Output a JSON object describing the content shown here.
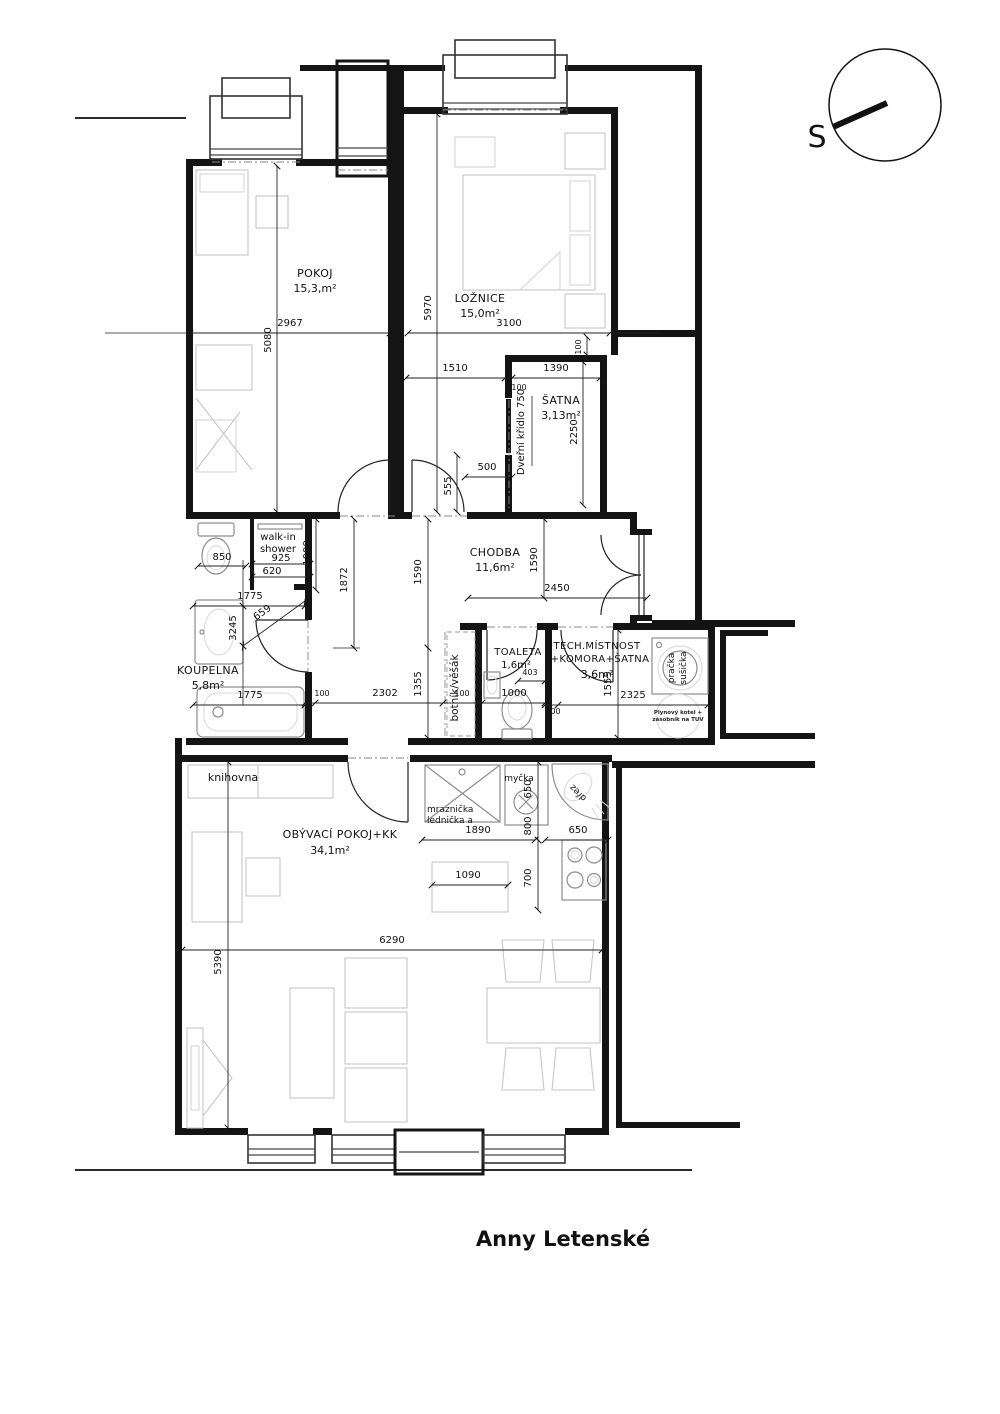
{
  "title": "Anny Letenské",
  "compass": {
    "label": "S"
  },
  "rooms": {
    "pokoj": {
      "name": "POKOJ",
      "area": "15,3,m²"
    },
    "loznice": {
      "name": "LOŽNICE",
      "area": "15,0m²"
    },
    "satna": {
      "name": "ŠATNA",
      "area": "3,13m²"
    },
    "chodba": {
      "name": "CHODBA",
      "area": "11,6m²"
    },
    "koupelna": {
      "name": "KOUPELNA",
      "area": "5,8m²"
    },
    "toaleta": {
      "name": "TOALETA",
      "area": "1,6m²"
    },
    "tech": {
      "name": "TECH.MÍSTNOST",
      "name2": "+KOMORA+ŠATNA",
      "area": "3,6m²"
    },
    "obyvaci": {
      "name": "OBÝVACÍ  POKOJ+KK",
      "area": "34,1m²"
    }
  },
  "labels": {
    "shower1": "walk-in",
    "shower2": "shower",
    "door_leaf": "Dveřní křídlo 750",
    "botnik": "botník/věšák",
    "pracka1": "pračka",
    "pracka2": "sušička",
    "kotel1": "Plynový kotel +",
    "kotel2": "zásobník na TUV",
    "knihovna": "knihovna",
    "mraz1": "mraznička",
    "mraz2": "lednička a",
    "mycka": "myčka",
    "drez": "dřez"
  },
  "dims": {
    "pokoj_w": "2967",
    "pokoj_h": "5080",
    "loz_h": "5970",
    "loz_w": "3100",
    "satna_off": "1510",
    "satna_w": "1390",
    "satna_h": "2250",
    "satna_gap_v": "100",
    "satna_gap_h": "100",
    "satna_door_w": "500",
    "satna_door_off": "555",
    "shower_w": "925",
    "shower_620": "620",
    "shower_1000": "1000",
    "koup_1775a": "1775",
    "koup_1775b": "1775",
    "koup_h": "3245",
    "koup_diag": "659",
    "wc_off": "850",
    "ch_1872": "1872",
    "ch_1590a": "1590",
    "ch_1590b": "1590",
    "ch_2450": "2450",
    "ch_2302": "2302",
    "ch_100a": "100",
    "ch_100b": "100",
    "ch_1355": "1355",
    "wc2_w": "1000",
    "wc2_403": "403",
    "tech_h": "1555",
    "tech_w": "2325",
    "tech_100": "100",
    "kk_1890": "1890",
    "kk_800": "800",
    "kk_650a": "650",
    "kk_650b": "650",
    "kk_1090": "1090",
    "kk_700": "700",
    "ob_w": "6290",
    "ob_h": "5390"
  }
}
